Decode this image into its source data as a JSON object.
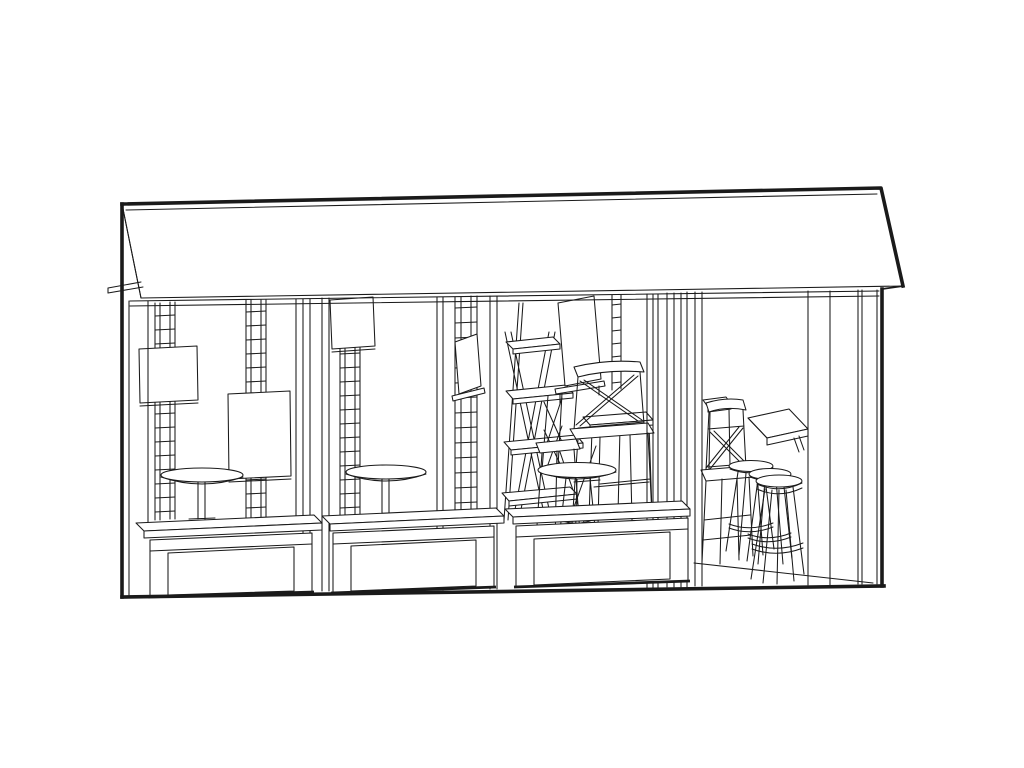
{
  "artwork": {
    "kind": "black-and-white architectural line drawing",
    "subject": "cafe kiosk storefront in three-quarter perspective: awning roof over three display windows with planter benches and an open bar section at right",
    "visible_text": ""
  },
  "colors": {
    "ink": "#1a1a1a",
    "paper": "#ffffff"
  },
  "elements": {
    "roof": "awning-roof",
    "bays": [
      "display-window-1",
      "display-window-2",
      "display-window-3",
      "open-bar-section"
    ],
    "window_1_contents": [
      "ladder-trellis",
      "picture-frame",
      "picture-frame",
      "round-cafe-table"
    ],
    "window_2_contents": [
      "hanging-sign",
      "ladder-trellis",
      "round-cafe-table",
      "menu-board"
    ],
    "window_3_contents": [
      "ladder-shelf",
      "display-easel",
      "cross-back-chair",
      "dining-table",
      "round-stool-table"
    ],
    "bar_section_contents": [
      "side-table",
      "cross-back-chair",
      "wall-bar-shelf",
      "bar-stool",
      "bar-stool",
      "bar-stool"
    ],
    "base": [
      "planter-bench-1",
      "planter-bench-2",
      "planter-bench-3",
      "ground-line"
    ]
  }
}
